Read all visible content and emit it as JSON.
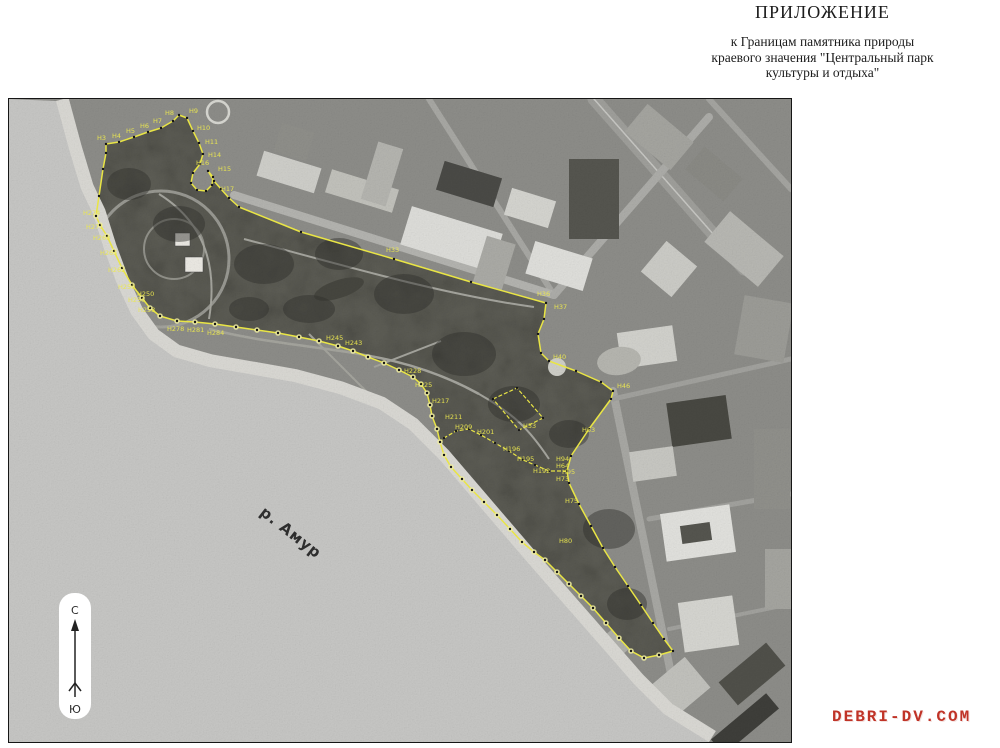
{
  "header": {
    "title": "ПРИЛОЖЕНИЕ",
    "subtitle_lines": [
      "к Границам памятника природы",
      "краевого значения \"Центральный парк",
      "культуры и отдыха\""
    ]
  },
  "map": {
    "river_label": "р. Амур",
    "compass": {
      "north": "С",
      "south": "Ю"
    },
    "boundary_color": "#e9e545",
    "marker_dot_color": "#141414",
    "bank_blob_color": "#efeca0",
    "boundary": {
      "main_loop": [
        [
          87,
          117
        ],
        [
          90,
          97
        ],
        [
          94,
          70
        ],
        [
          97,
          54
        ],
        [
          97,
          45
        ],
        [
          110,
          43
        ],
        [
          125,
          38
        ],
        [
          139,
          33
        ],
        [
          152,
          29
        ],
        [
          164,
          22
        ],
        [
          170,
          16
        ],
        [
          178,
          19
        ],
        [
          184,
          32
        ],
        [
          190,
          44
        ],
        [
          194,
          55
        ],
        [
          191,
          65
        ],
        [
          184,
          74
        ],
        [
          182,
          84
        ],
        [
          188,
          91
        ],
        [
          197,
          92
        ],
        [
          203,
          86
        ],
        [
          204,
          78
        ],
        [
          199,
          72
        ],
        [
          205,
          82
        ],
        [
          212,
          90
        ],
        [
          220,
          99
        ],
        [
          230,
          108
        ],
        [
          292,
          133
        ],
        [
          385,
          160
        ],
        [
          462,
          183
        ],
        [
          537,
          204
        ],
        [
          535,
          220
        ],
        [
          529,
          235
        ],
        [
          532,
          254
        ],
        [
          540,
          262
        ],
        [
          567,
          272
        ],
        [
          592,
          283
        ],
        [
          604,
          292
        ],
        [
          602,
          300
        ],
        [
          580,
          330
        ],
        [
          562,
          357
        ],
        [
          558,
          372
        ],
        [
          560,
          384
        ],
        [
          570,
          405
        ],
        [
          582,
          427
        ],
        [
          594,
          449
        ],
        [
          606,
          468
        ],
        [
          619,
          487
        ],
        [
          632,
          506
        ],
        [
          644,
          524
        ],
        [
          655,
          540
        ],
        [
          664,
          552
        ],
        [
          650,
          556
        ],
        [
          635,
          559
        ],
        [
          622,
          552
        ],
        [
          610,
          539
        ],
        [
          597,
          524
        ],
        [
          584,
          509
        ],
        [
          572,
          497
        ],
        [
          560,
          485
        ],
        [
          548,
          473
        ],
        [
          536,
          461
        ],
        [
          525,
          453
        ],
        [
          513,
          443
        ],
        [
          501,
          430
        ],
        [
          488,
          416
        ],
        [
          475,
          403
        ],
        [
          463,
          391
        ],
        [
          453,
          380
        ],
        [
          442,
          368
        ],
        [
          435,
          356
        ],
        [
          431,
          343
        ],
        [
          428,
          330
        ],
        [
          423,
          317
        ],
        [
          421,
          306
        ],
        [
          418,
          294
        ],
        [
          412,
          285
        ],
        [
          404,
          278
        ],
        [
          390,
          271
        ],
        [
          375,
          264
        ],
        [
          359,
          258
        ],
        [
          344,
          252
        ],
        [
          329,
          247
        ],
        [
          310,
          242
        ],
        [
          290,
          238
        ],
        [
          269,
          234
        ],
        [
          248,
          231
        ],
        [
          227,
          228
        ],
        [
          206,
          225
        ],
        [
          186,
          223
        ],
        [
          168,
          222
        ],
        [
          151,
          217
        ],
        [
          141,
          209
        ],
        [
          133,
          199
        ],
        [
          123,
          186
        ],
        [
          113,
          169
        ],
        [
          105,
          152
        ],
        [
          98,
          137
        ],
        [
          91,
          126
        ],
        [
          87,
          117
        ]
      ],
      "bank_start_index": 52,
      "extra_lines": [
        [
          [
            558,
            372
          ],
          [
            540,
            372
          ],
          [
            526,
            366
          ],
          [
            514,
            361
          ],
          [
            500,
            352
          ],
          [
            486,
            344
          ],
          [
            472,
            336
          ],
          [
            460,
            330
          ],
          [
            447,
            332
          ],
          [
            435,
            339
          ],
          [
            431,
            343
          ]
        ],
        [
          [
            484,
            300
          ],
          [
            508,
            289
          ],
          [
            534,
            319
          ],
          [
            510,
            331
          ],
          [
            484,
            300
          ]
        ]
      ]
    },
    "boundary_labels": [
      {
        "t": "Н3",
        "x": 88,
        "y": 41
      },
      {
        "t": "Н4",
        "x": 103,
        "y": 39
      },
      {
        "t": "Н5",
        "x": 117,
        "y": 34
      },
      {
        "t": "Н6",
        "x": 131,
        "y": 29
      },
      {
        "t": "Н7",
        "x": 144,
        "y": 24
      },
      {
        "t": "Н8",
        "x": 156,
        "y": 16
      },
      {
        "t": "Н9",
        "x": 180,
        "y": 14
      },
      {
        "t": "Н10",
        "x": 188,
        "y": 31
      },
      {
        "t": "Н11",
        "x": 196,
        "y": 45
      },
      {
        "t": "Н14",
        "x": 199,
        "y": 58
      },
      {
        "t": "Н15",
        "x": 209,
        "y": 72
      },
      {
        "t": "Н16",
        "x": 187,
        "y": 66
      },
      {
        "t": "Н17",
        "x": 212,
        "y": 92
      },
      {
        "t": "Н33",
        "x": 377,
        "y": 153
      },
      {
        "t": "Н36",
        "x": 528,
        "y": 197
      },
      {
        "t": "Н37",
        "x": 545,
        "y": 210
      },
      {
        "t": "Н40",
        "x": 544,
        "y": 260
      },
      {
        "t": "Н46",
        "x": 608,
        "y": 289
      },
      {
        "t": "Н53",
        "x": 514,
        "y": 329
      },
      {
        "t": "Н63",
        "x": 573,
        "y": 333
      },
      {
        "t": "Н64",
        "x": 547,
        "y": 369
      },
      {
        "t": "Н73",
        "x": 547,
        "y": 382
      },
      {
        "t": "Н75",
        "x": 556,
        "y": 404
      },
      {
        "t": "Н80",
        "x": 550,
        "y": 444
      },
      {
        "t": "Н94",
        "x": 547,
        "y": 362
      },
      {
        "t": "Н95",
        "x": 553,
        "y": 375
      },
      {
        "t": "Н192",
        "x": 524,
        "y": 374
      },
      {
        "t": "Н195",
        "x": 508,
        "y": 362
      },
      {
        "t": "Н196",
        "x": 494,
        "y": 352
      },
      {
        "t": "Н201",
        "x": 468,
        "y": 335
      },
      {
        "t": "Н209",
        "x": 446,
        "y": 330
      },
      {
        "t": "Н211",
        "x": 436,
        "y": 320
      },
      {
        "t": "Н217",
        "x": 423,
        "y": 304
      },
      {
        "t": "Н225",
        "x": 406,
        "y": 288
      },
      {
        "t": "Н228",
        "x": 395,
        "y": 274
      },
      {
        "t": "Н243",
        "x": 336,
        "y": 246
      },
      {
        "t": "Н245",
        "x": 317,
        "y": 241
      },
      {
        "t": "Н250",
        "x": 128,
        "y": 197
      },
      {
        "t": "Н253",
        "x": 129,
        "y": 213
      },
      {
        "t": "Н256",
        "x": 119,
        "y": 203
      },
      {
        "t": "Н259",
        "x": 109,
        "y": 190
      },
      {
        "t": "Н262",
        "x": 99,
        "y": 173
      },
      {
        "t": "Н265",
        "x": 91,
        "y": 156
      },
      {
        "t": "Н268",
        "x": 84,
        "y": 141
      },
      {
        "t": "Н271",
        "x": 77,
        "y": 130
      },
      {
        "t": "Н274",
        "x": 74,
        "y": 116
      },
      {
        "t": "Н278",
        "x": 158,
        "y": 232
      },
      {
        "t": "Н281",
        "x": 178,
        "y": 233
      },
      {
        "t": "Н284",
        "x": 198,
        "y": 236
      }
    ]
  },
  "watermark": {
    "text": "DEBRI-DV.COM",
    "color": "#c03327"
  }
}
